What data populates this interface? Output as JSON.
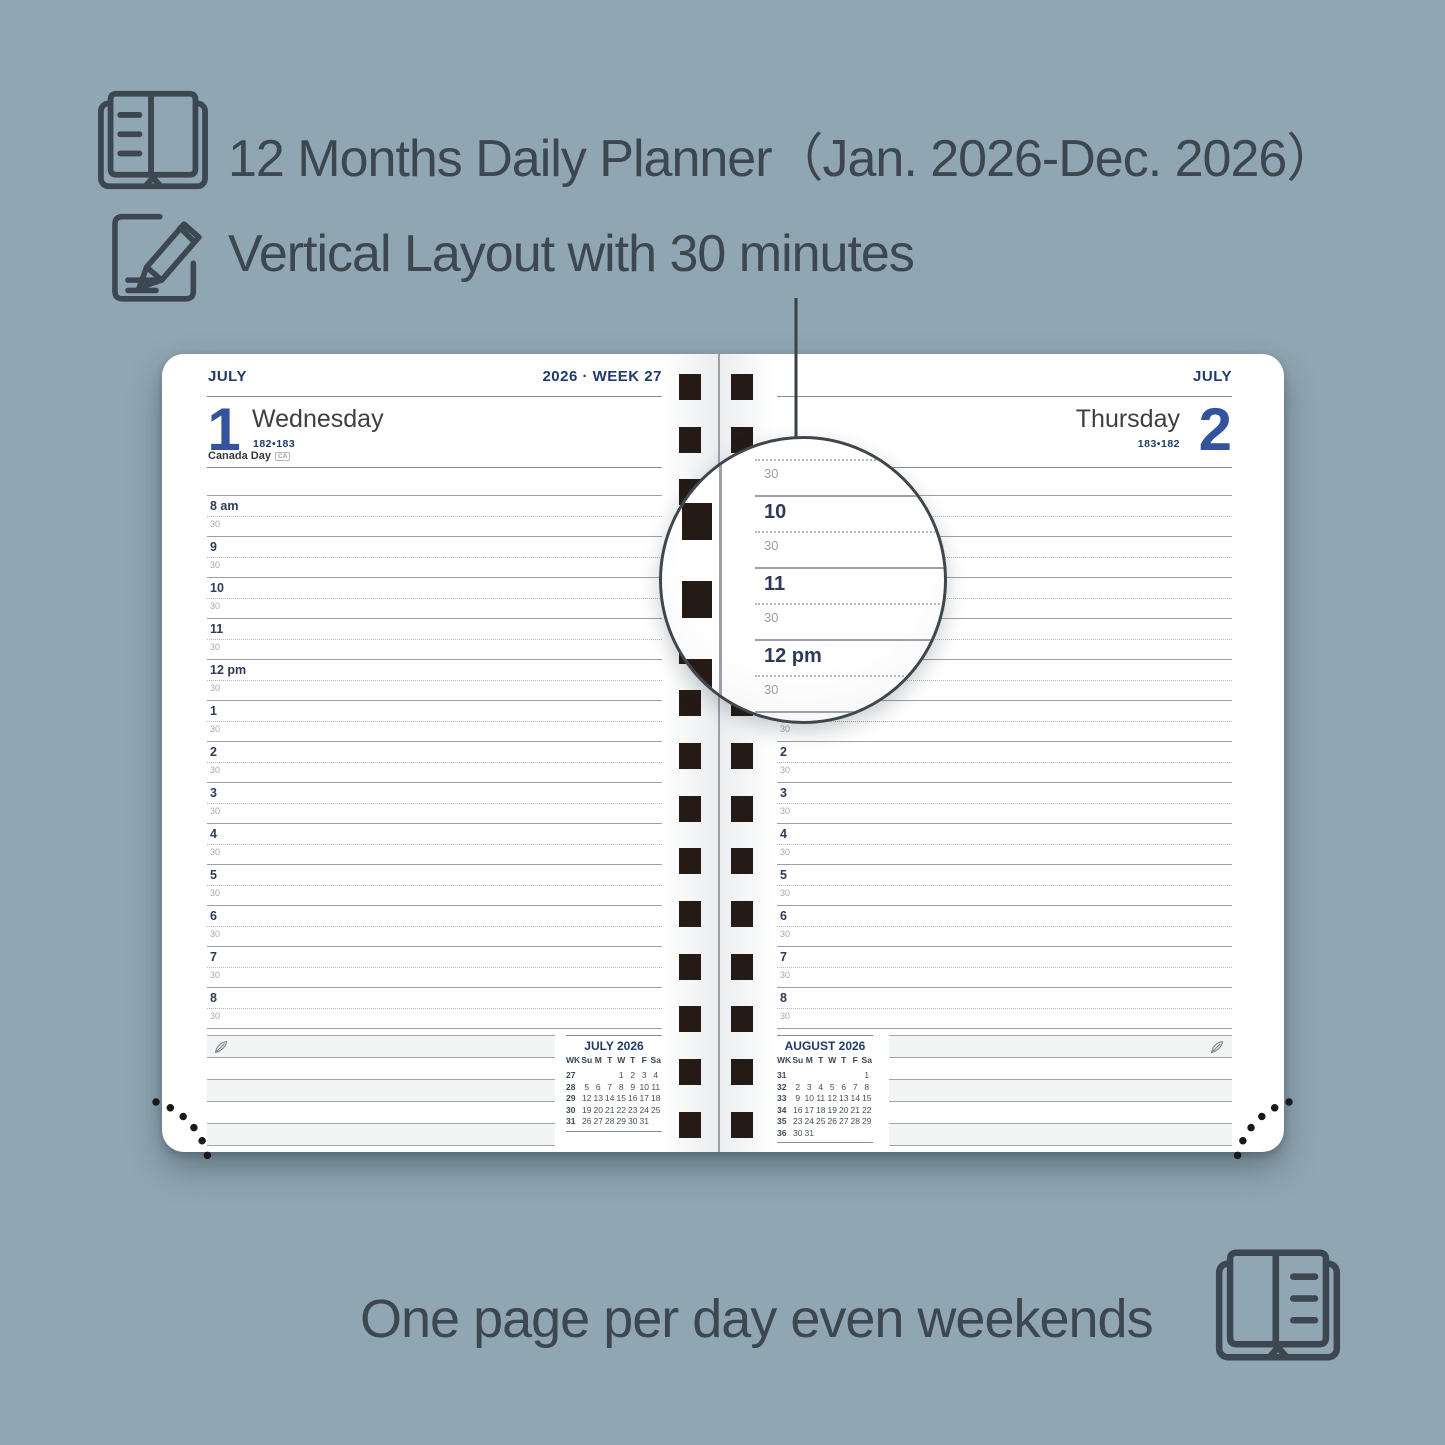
{
  "colors": {
    "background": "#90a7b3",
    "navy": "#1e3a70",
    "day_number_blue": "#33539e",
    "text_dark": "#3d4751",
    "spiral_square": "#241b16",
    "rule_gray": "#9aa0a5"
  },
  "features": [
    {
      "label": "12 Months Daily Planner（Jan. 2026-Dec. 2026）"
    },
    {
      "label": "Vertical Layout with 30 minutes"
    }
  ],
  "footer": {
    "label": "One page per day even weekends"
  },
  "planner": {
    "left_page": {
      "month": "JULY",
      "year_week": "2026 · WEEK 27",
      "day_number": "1",
      "day_name": "Wednesday",
      "day_of_year": "182•183",
      "holiday": "Canada Day",
      "holiday_tag": "CA"
    },
    "right_page": {
      "month": "JULY",
      "day_number": "2",
      "day_name": "Thursday",
      "day_of_year": "183•182"
    },
    "time_grid": {
      "hours": [
        "8 am",
        "9",
        "10",
        "11",
        "12 pm",
        "1",
        "2",
        "3",
        "4",
        "5",
        "6",
        "7",
        "8"
      ],
      "half_label": "30"
    },
    "magnifier_rows": [
      {
        "t": "half",
        "label": "30"
      },
      {
        "t": "hour",
        "label": "10"
      },
      {
        "t": "half",
        "label": "30"
      },
      {
        "t": "hour",
        "label": "11"
      },
      {
        "t": "half",
        "label": "30"
      },
      {
        "t": "hour",
        "label": "12 pm"
      },
      {
        "t": "half",
        "label": "30"
      },
      {
        "t": "hour",
        "label": "1"
      }
    ],
    "mini_calendars": [
      {
        "title": "JULY 2026",
        "dow": [
          "WK",
          "Su",
          "M",
          "T",
          "W",
          "T",
          "F",
          "Sa"
        ],
        "weeks": [
          [
            "27",
            "",
            "",
            "",
            "1",
            "2",
            "3",
            "4"
          ],
          [
            "28",
            "5",
            "6",
            "7",
            "8",
            "9",
            "10",
            "11"
          ],
          [
            "29",
            "12",
            "13",
            "14",
            "15",
            "16",
            "17",
            "18"
          ],
          [
            "30",
            "19",
            "20",
            "21",
            "22",
            "23",
            "24",
            "25"
          ],
          [
            "31",
            "26",
            "27",
            "28",
            "29",
            "30",
            "31",
            ""
          ]
        ]
      },
      {
        "title": "AUGUST 2026",
        "dow": [
          "WK",
          "Su",
          "M",
          "T",
          "W",
          "T",
          "F",
          "Sa"
        ],
        "weeks": [
          [
            "31",
            "",
            "",
            "",
            "",
            "",
            "",
            "1"
          ],
          [
            "32",
            "2",
            "3",
            "4",
            "5",
            "6",
            "7",
            "8"
          ],
          [
            "33",
            "9",
            "10",
            "11",
            "12",
            "13",
            "14",
            "15"
          ],
          [
            "34",
            "16",
            "17",
            "18",
            "19",
            "20",
            "21",
            "22"
          ],
          [
            "35",
            "23",
            "24",
            "25",
            "26",
            "27",
            "28",
            "29"
          ],
          [
            "36",
            "30",
            "31",
            "",
            "",
            "",
            "",
            ""
          ]
        ]
      }
    ]
  }
}
